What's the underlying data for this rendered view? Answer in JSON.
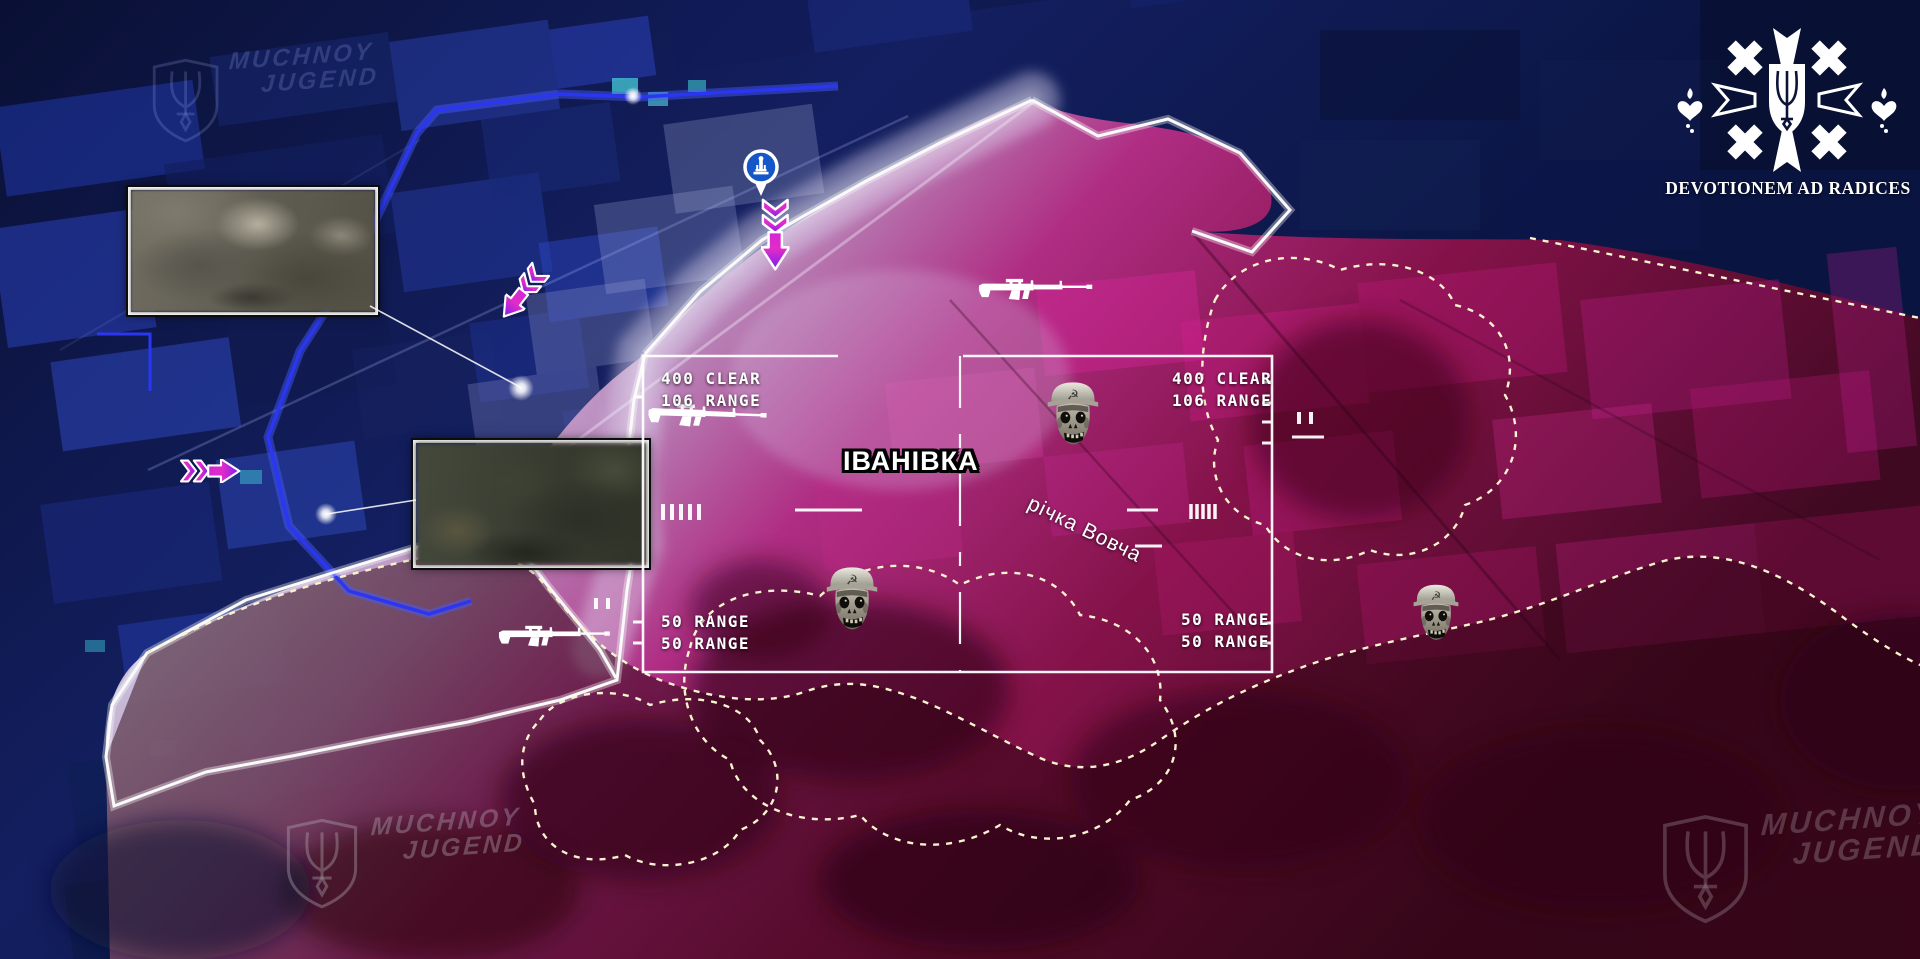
{
  "logo": {
    "motto": "DEVOTIONEM AD RADICES"
  },
  "watermarks": {
    "line1": "MUCHNOY",
    "line2": "JUGEND"
  },
  "labels": {
    "town": "ІВАНІВКА",
    "river": "річка Вовча"
  },
  "hud": {
    "left_top": [
      "400 CLEAR",
      "106 RANGE"
    ],
    "left_bottom": [
      "50 RANGE",
      "50 RANGE"
    ],
    "right_top": [
      "400 CLEAR",
      "106 RANGE"
    ],
    "right_bottom": [
      "50 RANGE",
      "50 RANGE"
    ]
  },
  "icons": {
    "enemy_soldier": "soviet-helmet-zombie-skull",
    "rifle": "assault-rifle-silhouette",
    "advance_arrow": "chevron-advance-arrow",
    "landmark_pin": "monument-map-pin",
    "emblem": "cross-trident-shield-with-hearts",
    "watermark_shield": "trident-shield",
    "hammer_sickle": "☭"
  },
  "markers": {
    "soldier_icons": 3,
    "rifle_icons": 3,
    "advance_arrows": 3,
    "recon_insets": 2
  },
  "colors": {
    "friendly_zone": "#16246e",
    "friendly_line": "#2b36f2",
    "enemy_zone": "#b01d6e",
    "enemy_deep_zone": "#3a0512",
    "contested_strip": "#d8cde4",
    "front_line": "#fafafa",
    "phase_line_dashed": "#f8f3cf",
    "arrow_tail": "#d426d8",
    "arrow_head": "#7a1ef0",
    "pin_fill": "#1557c8"
  }
}
